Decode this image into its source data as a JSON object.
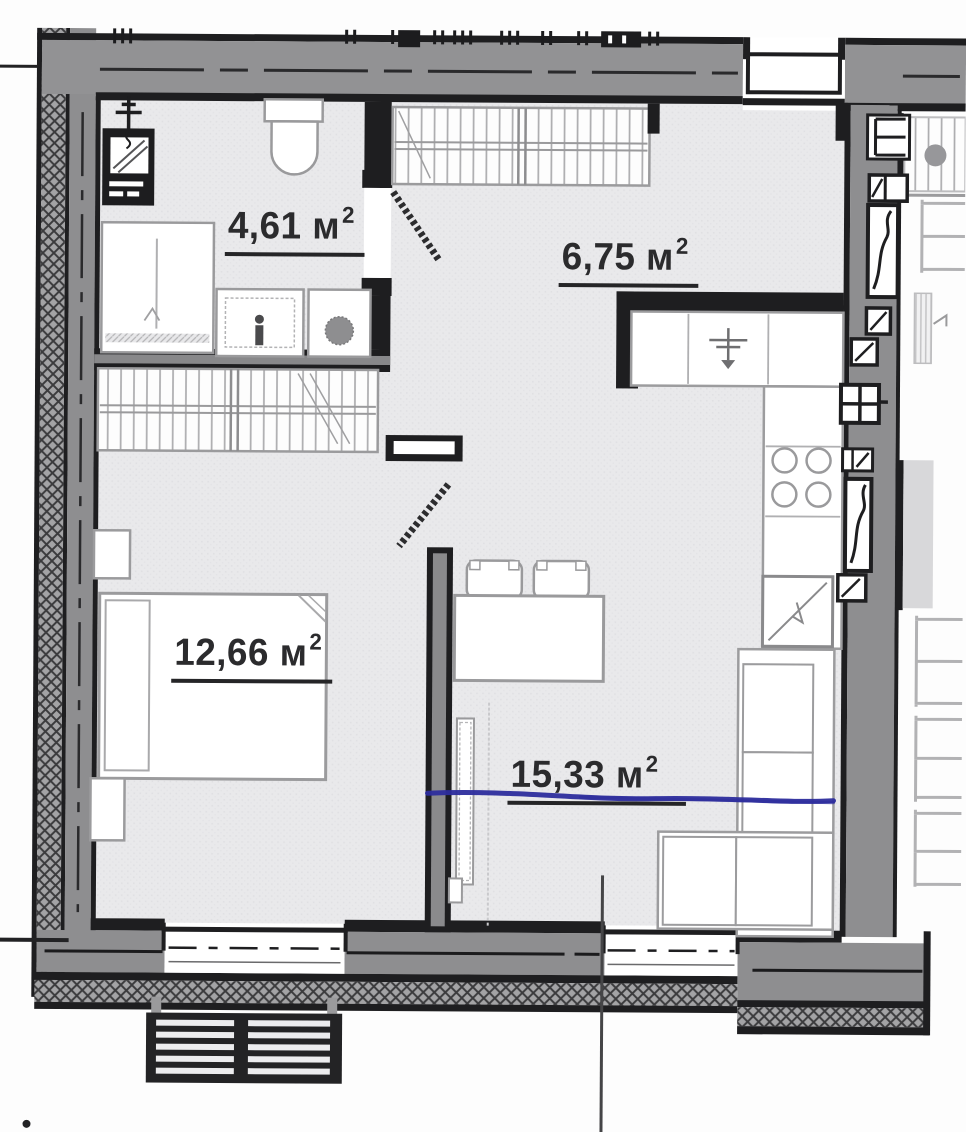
{
  "plan": {
    "rooms": [
      {
        "id": "bathroom",
        "area_label": "4,61 м",
        "area_sup": "2"
      },
      {
        "id": "hallway",
        "area_label": "6,75 м",
        "area_sup": "2"
      },
      {
        "id": "bedroom",
        "area_label": "12,66 м",
        "area_sup": "2"
      },
      {
        "id": "living-kitchen",
        "area_label": "15,33 м",
        "area_sup": "2"
      }
    ],
    "colors": {
      "wall_line_dark": "#1e1e20",
      "wall_core_gray": "#8e8e90",
      "floor_tint": "#e9e9eb",
      "furniture_outline": "#9b9b9d",
      "pen_annotation_blue": "#2d2d9d"
    },
    "fixtures": [
      "toilet",
      "washing-machine",
      "shower-tray",
      "bathroom-sink",
      "built-in-wardrobe",
      "double-bed",
      "nightstand",
      "kitchen-counter",
      "kitchen-sink",
      "cooktop-4-burners",
      "oven",
      "dining-table",
      "chair",
      "corner-sofa",
      "tv-cabinet",
      "entrance-door",
      "interior-door",
      "window",
      "balcony-grate",
      "ventilation-shaft"
    ]
  }
}
